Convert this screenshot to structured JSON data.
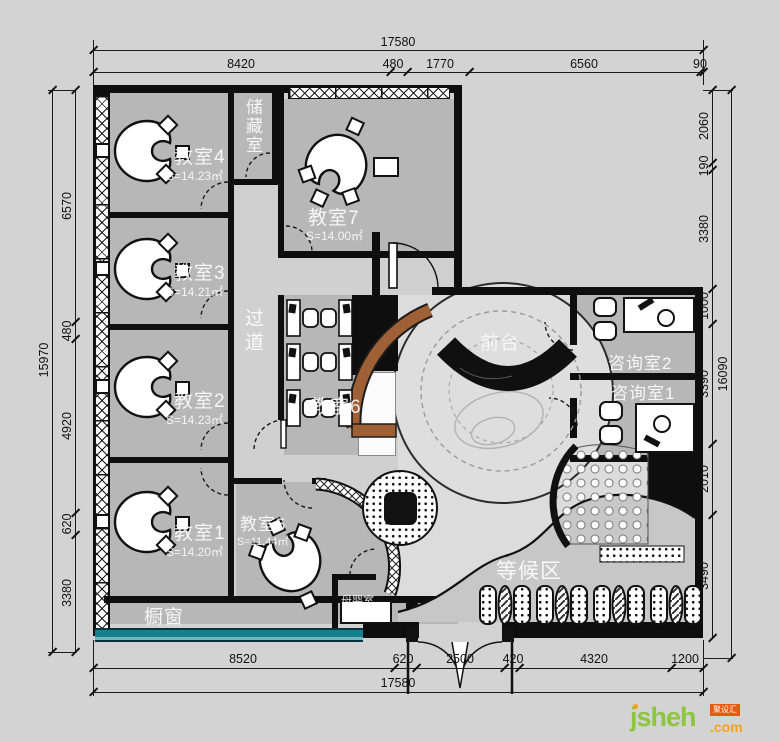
{
  "rooms": {
    "classroom4": {
      "name": "教室4",
      "area": "S=14.23㎡"
    },
    "classroom3": {
      "name": "教室3",
      "area": "S=14.21㎡"
    },
    "classroom2": {
      "name": "教室2",
      "area": "S=14.23㎡"
    },
    "classroom1": {
      "name": "教室1",
      "area": "S=14.20㎡"
    },
    "classroom5": {
      "name": "教室5",
      "area": "S=11.44㎡"
    },
    "classroom6": {
      "name": "教室6"
    },
    "classroom7": {
      "name": "教室7",
      "area": "S=14.00㎡"
    },
    "storage": {
      "name": "储藏室"
    },
    "corridor": {
      "name": "过道"
    },
    "reception": {
      "name": "前台"
    },
    "consult_room2": {
      "name": "咨询室2"
    },
    "consult_room1": {
      "name": "咨询室1"
    },
    "waiting_area": {
      "name": "等候区"
    },
    "display_window": {
      "name": "橱窗"
    },
    "nursing_room": {
      "name": "母婴室"
    }
  },
  "dims": {
    "top_total": "17580",
    "top_segments": [
      "8420",
      "480",
      "1770",
      "6560",
      "90"
    ],
    "bottom_segments": [
      "8520",
      "620",
      "2500",
      "420",
      "4320",
      "1200"
    ],
    "bottom_total": "17580",
    "left_total": "15970",
    "left_segments": [
      "6570",
      "480",
      "4920",
      "620",
      "3380"
    ],
    "right_total": "16090",
    "right_segments": [
      "2060",
      "190",
      "3380",
      "1000",
      "3390",
      "2010",
      "3490"
    ]
  },
  "logo": {
    "brand": "jsheh",
    "tld": ".com",
    "badge": "聚设汇"
  },
  "colors": {
    "wall": "#0e0e0e",
    "room_fill": "#b7b7b7",
    "accent_teal": "#17808f",
    "wood_counter": "#a06035",
    "background": "#d3d3d3"
  }
}
